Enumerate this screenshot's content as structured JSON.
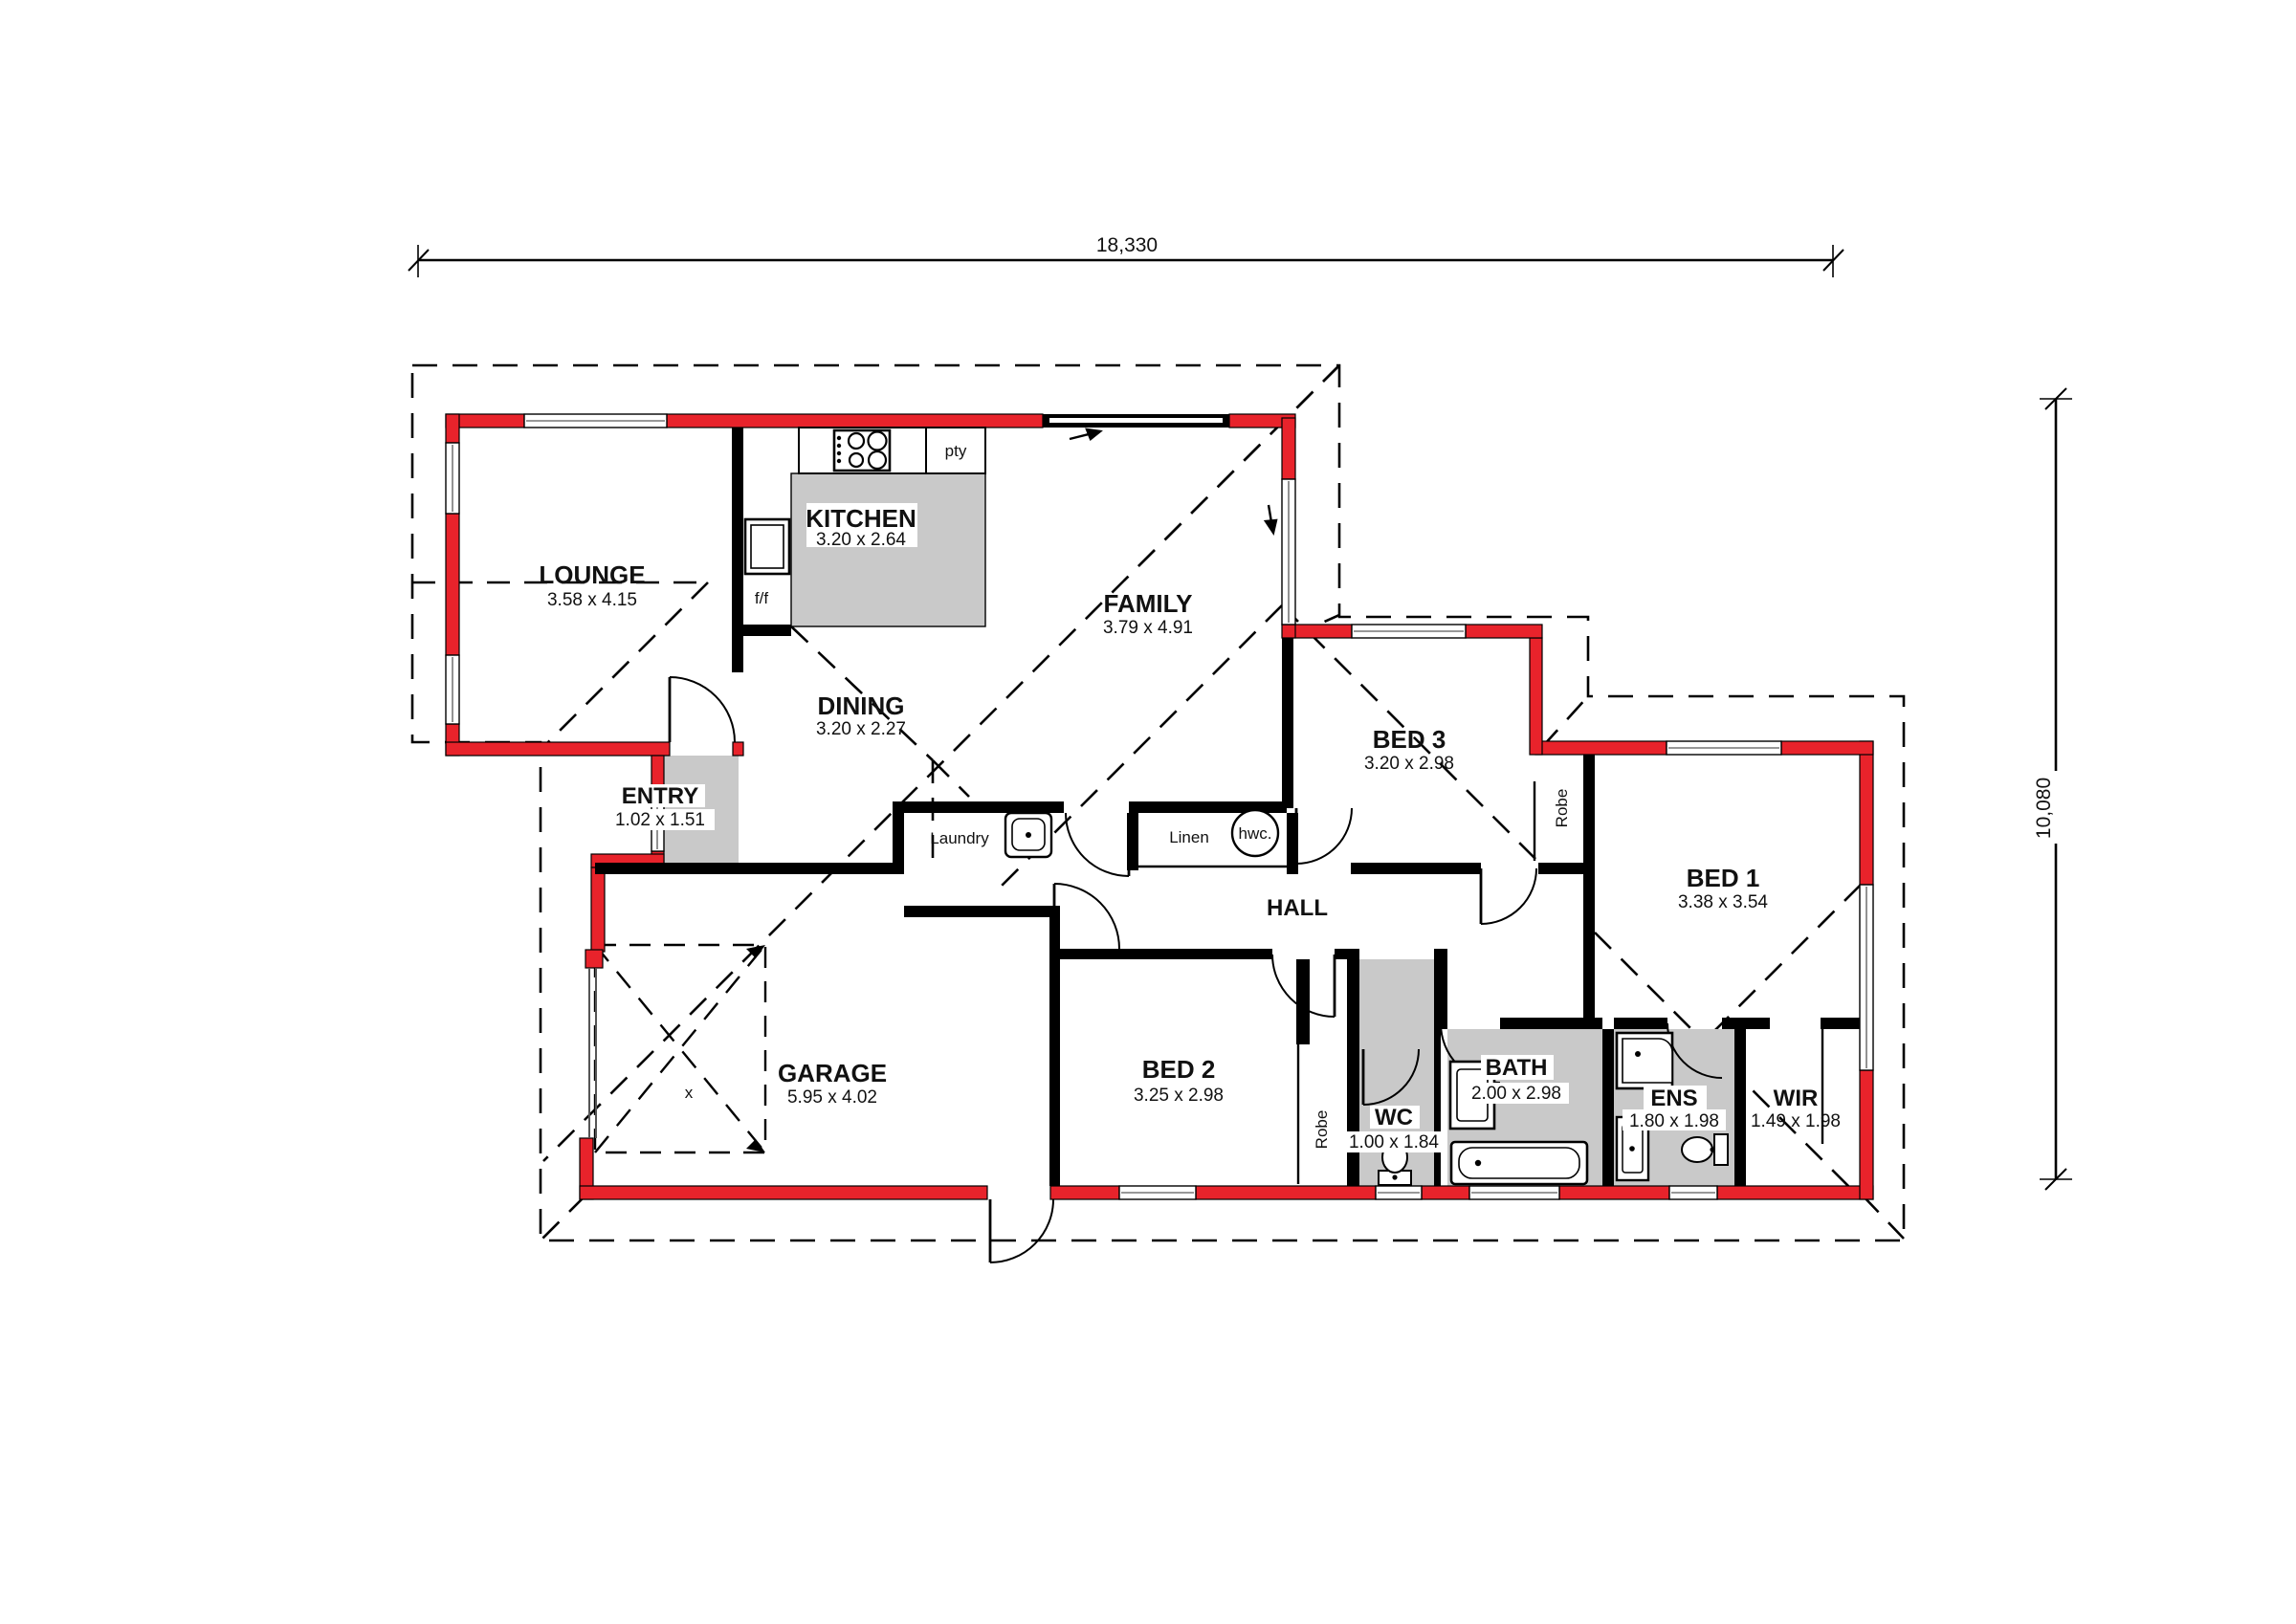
{
  "drawing": {
    "type": "floor-plan",
    "overall_dimensions": {
      "width": "18,330",
      "height": "10,080"
    }
  },
  "rooms": [
    {
      "name": "LOUNGE",
      "dims": "3.58 x 4.15"
    },
    {
      "name": "KITCHEN",
      "dims": "3.20 x 2.64"
    },
    {
      "name": "FAMILY",
      "dims": "3.79 x 4.91"
    },
    {
      "name": "DINING",
      "dims": "3.20 x 2.27"
    },
    {
      "name": "ENTRY",
      "dims": "1.02 x 1.51"
    },
    {
      "name": "GARAGE",
      "dims": "5.95 x 4.02"
    },
    {
      "name": "BED 3",
      "dims": "3.20 x 2.98"
    },
    {
      "name": "BED 1",
      "dims": "3.38 x 3.54"
    },
    {
      "name": "BED 2",
      "dims": "3.25 x 2.98"
    },
    {
      "name": "WC",
      "dims": "1.00 x 1.84"
    },
    {
      "name": "BATH",
      "dims": "2.00 x 2.98"
    },
    {
      "name": "ENS",
      "dims": "1.80 x 1.98"
    },
    {
      "name": "WIR",
      "dims": "1.49 x 1.98"
    },
    {
      "name": "HALL",
      "dims": ""
    }
  ],
  "features": {
    "pantry": "pty",
    "fridge": "f/f",
    "laundry": "Laundry",
    "linen": "Linen",
    "hot_water_cylinder": "hwc.",
    "robe_bed3": "Robe",
    "robe_bed2": "Robe",
    "garage_cross_mark": "x"
  },
  "colors": {
    "exterior_wall": "#e8232b",
    "interior_wall": "#000000",
    "wet_area_floor": "#c9c9c9",
    "line": "#000000"
  }
}
